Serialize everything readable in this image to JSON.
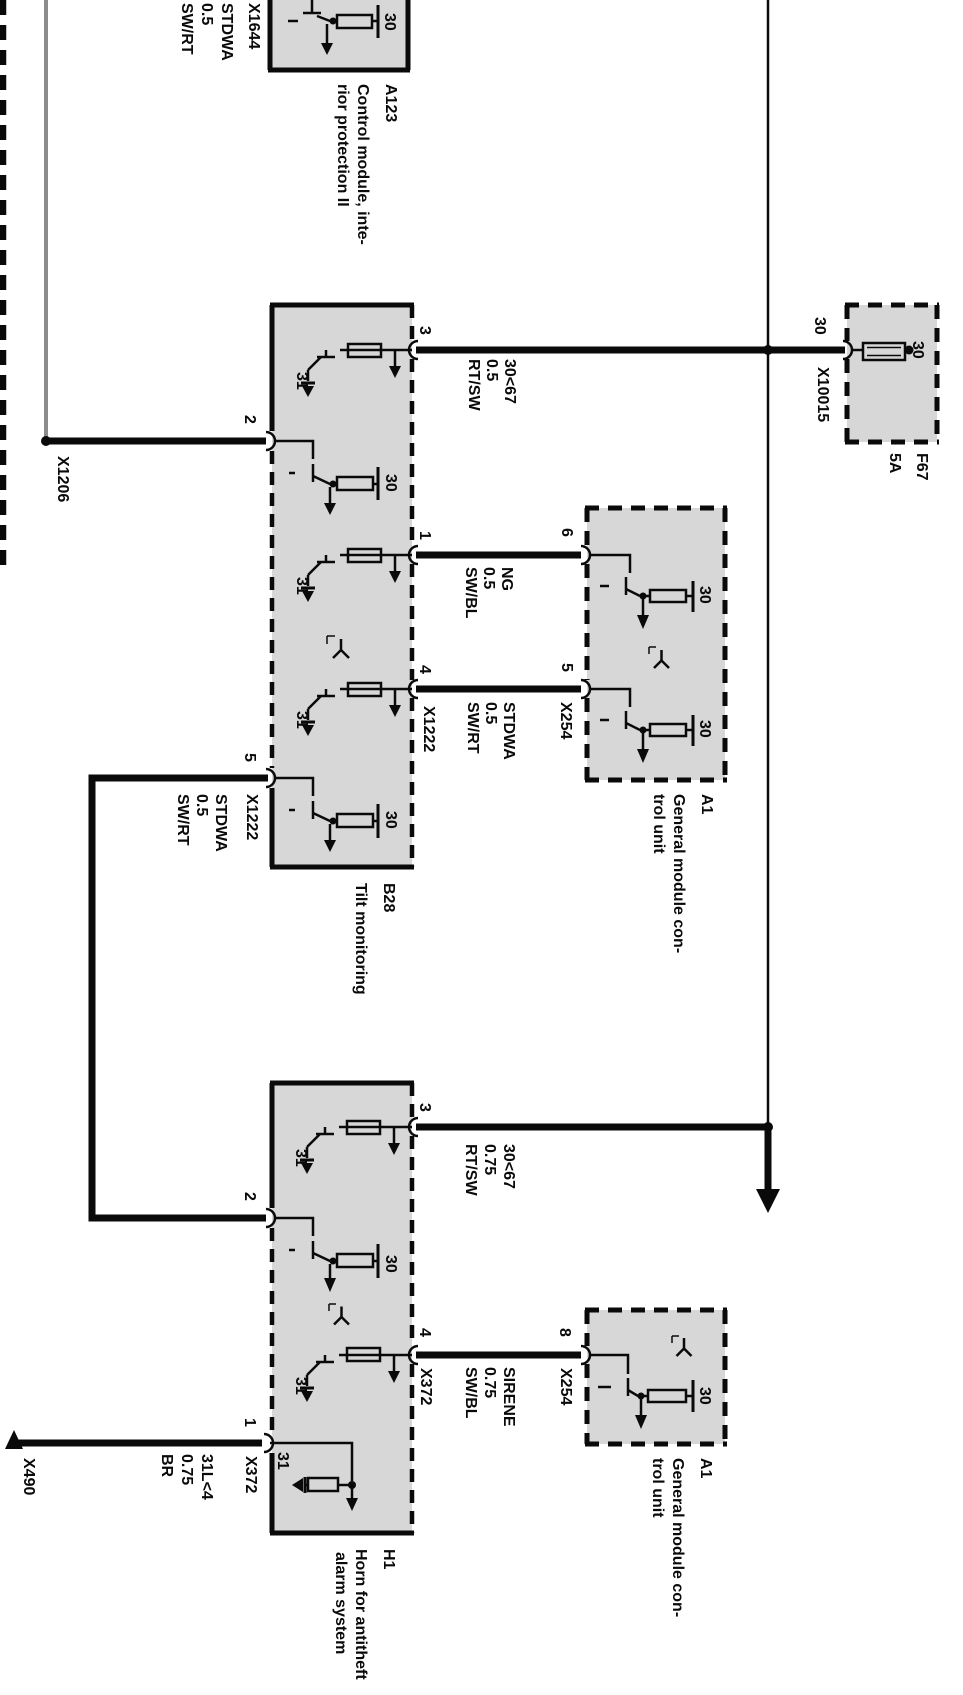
{
  "diagram": {
    "t": {
      "plus": "30",
      "ground": "31"
    },
    "a123": {
      "id": "A123",
      "desc1": "Control module, inte-",
      "desc2": "rior protection II",
      "connector": "X1644",
      "wire": {
        "signal": "STDWA",
        "gauge": "0.5",
        "color": "SW/RT"
      }
    },
    "x1206": "X1206",
    "b28": {
      "id": "B28",
      "desc": "Tilt monitoring",
      "pin3": "3",
      "pin2": "2",
      "pin1": "1",
      "pin4": "4",
      "pin5": "5",
      "x1222": "X1222",
      "wire3": {
        "signal": "30<67",
        "gauge": "0.5",
        "color": "RT/SW"
      },
      "wire1": {
        "signal": "NG",
        "gauge": "0.5",
        "color": "SW/BL"
      },
      "wire4": {
        "signal": "STDWA",
        "gauge": "0.5",
        "color": "SW/RT"
      },
      "wire5": {
        "signal": "STDWA",
        "gauge": "0.5",
        "color": "SW/RT"
      }
    },
    "fuse": {
      "id": "F67",
      "rating": "5A",
      "connector": "X10015"
    },
    "a1a": {
      "id": "A1",
      "desc1": "General module con-",
      "desc2": "trol unit",
      "pin6": "6",
      "pin5": "5",
      "connector": "X254"
    },
    "a1b": {
      "id": "A1",
      "desc1": "General module con-",
      "desc2": "trol unit",
      "pin8": "8",
      "connector": "X254"
    },
    "h1": {
      "id": "H1",
      "desc1": "Horn for antitheft",
      "desc2": "alarm system",
      "pin3": "3",
      "pin2": "2",
      "pin4": "4",
      "pin1": "1",
      "x372": "X372",
      "wire3": {
        "signal": "30<67",
        "gauge": "0.75",
        "color": "RT/SW"
      },
      "wire4": {
        "signal": "SIRENE",
        "gauge": "0.75",
        "color": "SW/BL"
      },
      "wire1": {
        "signal": "31L<4",
        "gauge": "0.75",
        "color": "BR"
      }
    },
    "x490": "X490",
    "colors": {
      "wire": "#0a0a0a",
      "module_fill": "#d7d7d7",
      "feed_line": "#8c8c8c",
      "background": "#ffffff"
    }
  }
}
